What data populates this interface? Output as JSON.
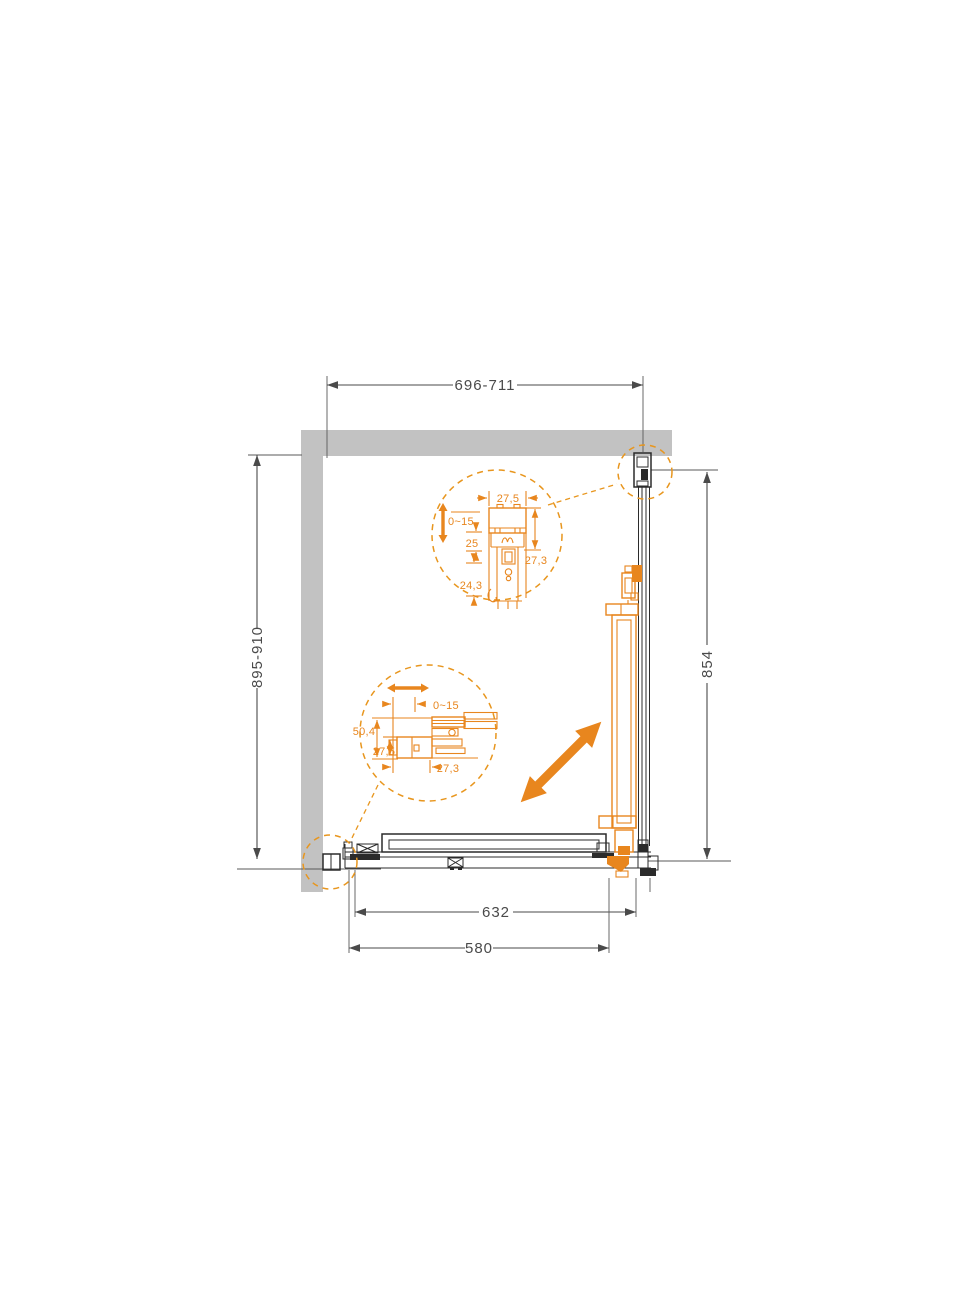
{
  "drawing": {
    "type": "shower-enclosure-technical-plan",
    "colors": {
      "accent_orange": "#E8861E",
      "line": "#4a4a4a",
      "wall_gray": "#c2c2c2",
      "background": "#ffffff"
    },
    "dims": {
      "top_width": "696-711",
      "left_height": "895-910",
      "right_height": "854",
      "bottom_glass_width": "632",
      "bottom_opening_width": "580"
    },
    "detail_top": {
      "profile_width": "27,5",
      "adjustment_range": "0~15",
      "mid_depth": "25",
      "profile_height": "27,3",
      "lower_depth": "24,3"
    },
    "detail_side": {
      "adjustment_range": "0~15",
      "total_depth": "50,4",
      "profile_depth": "27,5",
      "profile_width": "27,3"
    }
  }
}
